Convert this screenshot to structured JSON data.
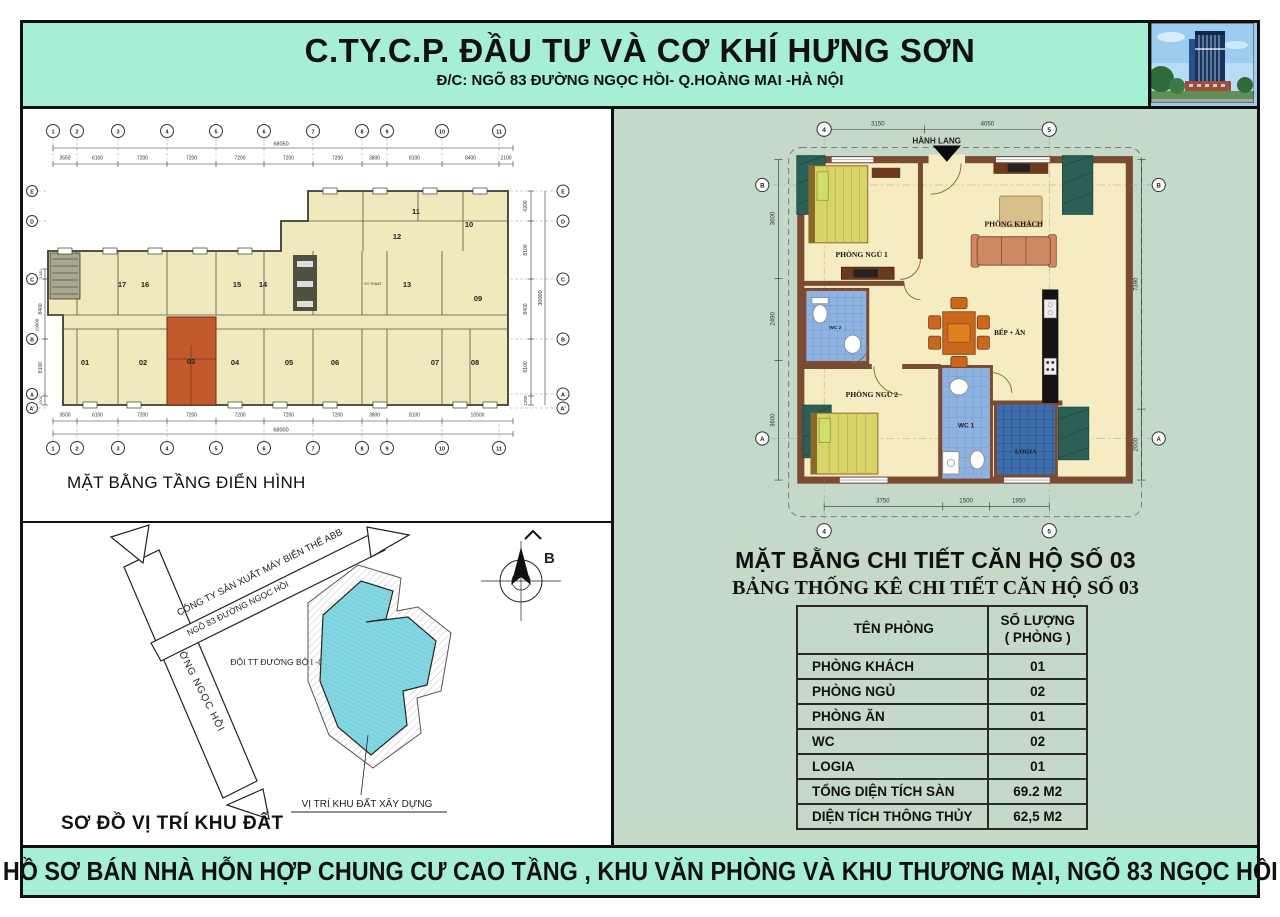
{
  "header": {
    "company": "C.TY.C.P. ĐẦU TƯ VÀ CƠ KHÍ HƯNG SƠN",
    "address": "Đ/C: NGÕ 83 ĐƯỜNG NGỌC HỒI- Q.HOÀNG MAI -HÀ NỘI"
  },
  "footer": {
    "text": "HỒ SƠ BÁN NHÀ HỖN HỢP CHUNG CƯ CAO TẦNG , KHU VĂN PHÒNG VÀ KHU THƯƠNG MẠI, NGÕ 83 NGỌC HỒI"
  },
  "floorplan": {
    "caption": "MẶT BẰNG TẦNG ĐIỂN HÌNH",
    "grid_cols": [
      "1",
      "2",
      "3",
      "4",
      "5",
      "6",
      "7",
      "8",
      "9",
      "10",
      "11"
    ],
    "grid_rows_right": [
      "E",
      "D",
      "C",
      "B",
      "A",
      "A'"
    ],
    "grid_rows_left": [
      "E",
      "D",
      "C",
      "B",
      "A",
      "A'"
    ],
    "top_total": "68050",
    "top_dims": [
      "3550",
      "6100",
      "7200",
      "7200",
      "7200",
      "7200",
      "7200",
      "3800",
      "8100",
      "8400",
      "2100"
    ],
    "bottom_total": "68000",
    "bottom_dims": [
      "3500",
      "6100",
      "7200",
      "7200",
      "7200",
      "7200",
      "7200",
      "3800",
      "8100",
      "10500"
    ],
    "right_dims": [
      "4200",
      "8100",
      "8400",
      "8100",
      "1200"
    ],
    "right_total": "30000",
    "left_dims": [
      "1300",
      "8400",
      "8100",
      "1200"
    ],
    "left_total": "19000",
    "tech": "KY THUAT",
    "units": {
      "u01": "01",
      "u02": "02",
      "u03": "03",
      "u04": "04",
      "u05": "05",
      "u06": "06",
      "u07": "07",
      "u08": "08",
      "u09": "09",
      "u10": "10",
      "u11": "11",
      "u12": "12",
      "u13": "13",
      "u14": "14",
      "u15": "15",
      "u16": "16",
      "u17": "17"
    }
  },
  "sitemap": {
    "caption": "SƠ ĐỒ VỊ TRÍ KHU ĐẤT",
    "company_label": "CÔNG TY SẢN XUẤT MÁY BIẾN THẾ ABB",
    "alley_label": "NGÕ 83 ĐƯỜNG NGỌC HỒI",
    "road_team_label": "ĐỘI TT ĐƯỜNG BỘ I -06",
    "street_label": "ĐƯỜNG NGỌC HỒI",
    "site_label": "VỊ TRÍ KHU ĐẤT XÂY DỰNG",
    "north_label": "B"
  },
  "apartment": {
    "corridor_label": "HÀNH LANG",
    "rooms": {
      "bedroom1": "PHÒNG NGỦ 1",
      "living": "PHÒNG KHÁCH",
      "wc2": "WC 2",
      "kitchen": "BẾP + ĂN",
      "bedroom2": "PHÒNG NGỦ 2",
      "wc1": "WC 1",
      "logia": "LOGIA"
    },
    "dims": {
      "top": [
        "3150",
        "4050"
      ],
      "left": [
        "3600",
        "2490",
        "3600"
      ],
      "right": [
        "7390",
        "2000"
      ],
      "bottom": [
        "3750",
        "1500",
        "1950"
      ]
    },
    "grid": {
      "cols": [
        "4",
        "5"
      ],
      "rows": [
        "B",
        "A"
      ]
    }
  },
  "detail": {
    "title_plan": "MẶT BẰNG CHI TIẾT CĂN HỘ SỐ 03",
    "title_table": "BẢNG THỐNG KÊ CHI TIẾT CĂN HỘ SỐ 03",
    "table": {
      "header_room": "TÊN PHÒNG",
      "header_qty1": "SỐ LƯỢNG",
      "header_qty2": "( PHÒNG )",
      "rows": [
        {
          "name": "PHÒNG KHÁCH",
          "qty": "01"
        },
        {
          "name": "PHÒNG NGỦ",
          "qty": "02"
        },
        {
          "name": "PHÒNG ĂN",
          "qty": "01"
        },
        {
          "name": "WC",
          "qty": "02"
        },
        {
          "name": "LOGIA",
          "qty": "01"
        },
        {
          "name": "TỔNG DIỆN TÍCH SÀN",
          "qty": "69.2 M2"
        },
        {
          "name": "DIỆN TÍCH THÔNG THỦY",
          "qty": "62,5 M2"
        }
      ]
    }
  },
  "colors": {
    "mint": "#a6eed4",
    "panel": "#c5d9c8",
    "highlight": "#c25a2b",
    "site_cyan": "#85d6e3",
    "wc_blue": "#8fb3e0",
    "logia_blue": "#3e6dad"
  }
}
